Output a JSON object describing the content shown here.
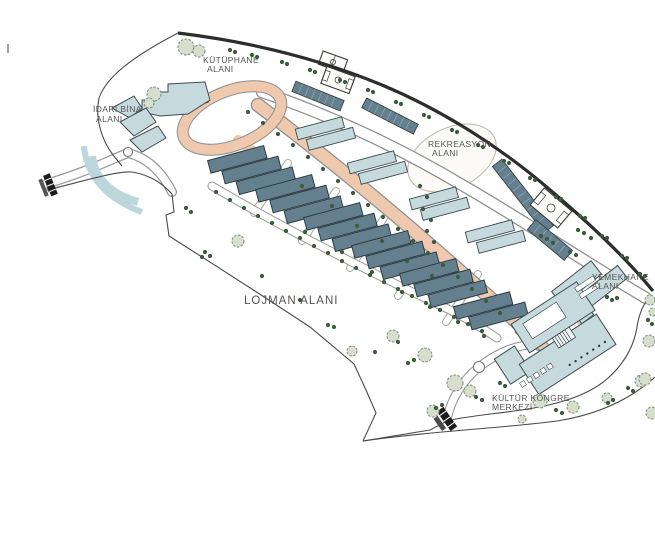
{
  "labels": {
    "library": {
      "line1": "KÜTÜPHANE",
      "line2": "ALANI"
    },
    "admin": {
      "line1": "İDARİ BİNA",
      "line2": "ALANI"
    },
    "recreation": {
      "line1": "REKREASYON",
      "line2": "ALANI"
    },
    "cafeteria": {
      "line1": "YEMEKHANE",
      "line2": "ALANI"
    },
    "housing": {
      "line1": "LOJMAN ALANI"
    },
    "culture_center": {
      "line1": "KÜLTÜR KONGRE",
      "line2": "MERKEZİ"
    }
  },
  "colors": {
    "background": "#ffffff",
    "boundary": "#4a4a4a",
    "boundary_heavy": "#2d2d2d",
    "road_fill": "#eec9ae",
    "road_edge": "#8f8f8f",
    "building_dark": "#64808e",
    "building_dark_stroke": "#2c3b43",
    "building_light": "#c6dade",
    "building_light_stroke": "#3c4c52",
    "tree_dot": "#3d5a3d",
    "tree_fill": "#d6decd",
    "tree_stroke": "#788c72",
    "label_text": "#555555",
    "gate": "#1c1c1c"
  }
}
